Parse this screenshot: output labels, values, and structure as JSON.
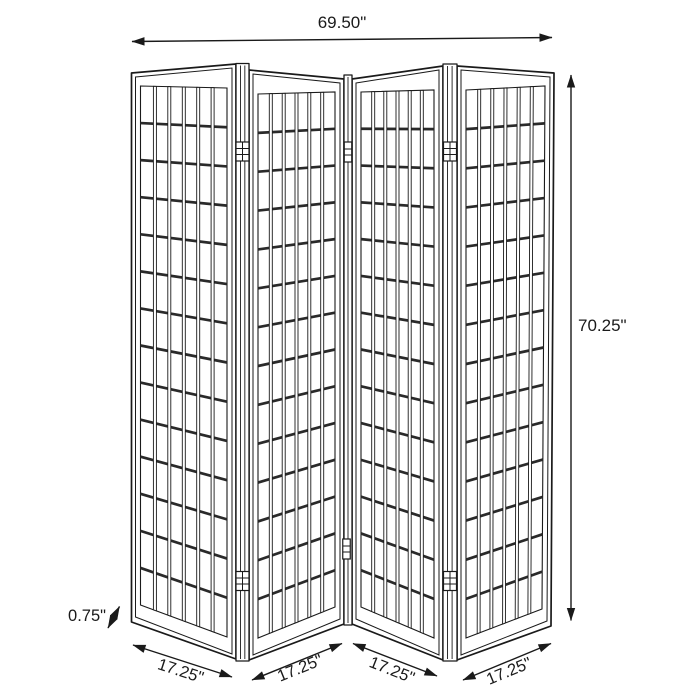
{
  "diagram": {
    "subject": "four-panel folding screen room divider",
    "style": {
      "background_color": "#ffffff",
      "line_color": "#1a1a1a",
      "rail_color": "#2a2a2a"
    },
    "panel_count": 4,
    "dimensions": {
      "overall_width": {
        "label": "69.50\"",
        "inches": 69.5
      },
      "overall_height": {
        "label": "70.25\"",
        "inches": 70.25
      },
      "panel_thickness": {
        "label": "0.75\"",
        "inches": 0.75
      },
      "panel_widths": [
        {
          "label": "17.25\"",
          "inches": 17.25
        },
        {
          "label": "17.25\"",
          "inches": 17.25
        },
        {
          "label": "17.25\"",
          "inches": 17.25
        },
        {
          "label": "17.25\"",
          "inches": 17.25
        }
      ]
    }
  }
}
